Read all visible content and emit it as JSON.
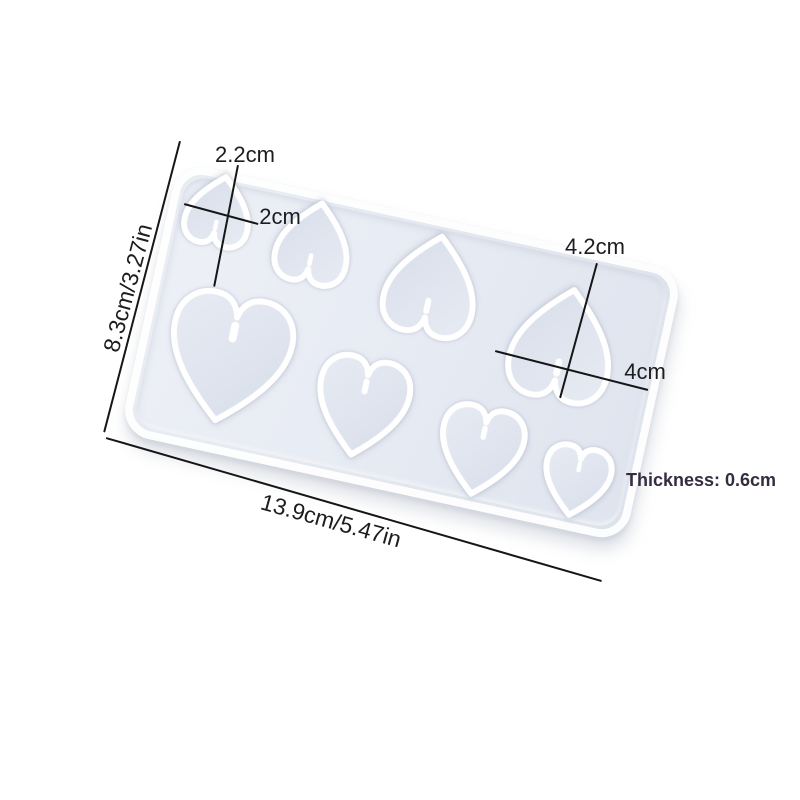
{
  "canvas": {
    "width": 800,
    "height": 800,
    "background": "#ffffff"
  },
  "mold": {
    "name": "heart pendant silicone mold",
    "surface_color": "#eaedf4",
    "rim_color": "#ffffff",
    "cavity_gradient": [
      "#e7ebf3",
      "#d8deea"
    ],
    "rect": {
      "left": 143,
      "top": 213,
      "width": 517,
      "height": 278,
      "rotation_deg": 12.3,
      "corner_radius": 30
    },
    "hearts": [
      {
        "id": 1,
        "cx": 219,
        "cy": 210,
        "w": 78,
        "h": 82,
        "orientation": "inverted",
        "rotation_deg": 192
      },
      {
        "id": 2,
        "cx": 314,
        "cy": 242,
        "w": 88,
        "h": 96,
        "orientation": "inverted",
        "rotation_deg": 192
      },
      {
        "id": 3,
        "cx": 432,
        "cy": 284,
        "w": 110,
        "h": 118,
        "orientation": "inverted",
        "rotation_deg": 192
      },
      {
        "id": 4,
        "cx": 563,
        "cy": 343,
        "w": 122,
        "h": 132,
        "orientation": "inverted",
        "rotation_deg": 192
      },
      {
        "id": 5,
        "cx": 228,
        "cy": 360,
        "w": 146,
        "h": 150,
        "orientation": "standard",
        "rotation_deg": 12
      },
      {
        "id": 6,
        "cx": 361,
        "cy": 408,
        "w": 110,
        "h": 116,
        "orientation": "standard",
        "rotation_deg": 12
      },
      {
        "id": 7,
        "cx": 480,
        "cy": 452,
        "w": 100,
        "h": 104,
        "orientation": "standard",
        "rotation_deg": 12
      },
      {
        "id": 8,
        "cx": 576,
        "cy": 482,
        "w": 80,
        "h": 82,
        "orientation": "standard",
        "rotation_deg": 12
      }
    ]
  },
  "annotations": {
    "text_color": "#1d1d1f",
    "line_color": "#161616",
    "labels": {
      "mold_height": {
        "text": "8.3cm/3.27in",
        "cx": 128,
        "cy": 288,
        "rotation_deg": -75
      },
      "mold_width": {
        "text": "13.9cm/5.47in",
        "cx": 331,
        "cy": 521,
        "rotation_deg": 15.5
      },
      "small_heart_height": {
        "text": "2.2cm",
        "cx": 245,
        "cy": 155,
        "rotation_deg": 0
      },
      "small_heart_width": {
        "text": "2cm",
        "cx": 280,
        "cy": 217,
        "rotation_deg": 0
      },
      "large_heart_height": {
        "text": "4.2cm",
        "cx": 595,
        "cy": 247,
        "rotation_deg": 0
      },
      "large_heart_width": {
        "text": "4cm",
        "cx": 645,
        "cy": 372,
        "rotation_deg": 0
      },
      "thickness": {
        "text": "Thickness: 0.6cm",
        "cx": 701,
        "cy": 480,
        "rotation_deg": 0,
        "color": "#362c40"
      }
    },
    "lines": [
      {
        "name": "mold-height-dimension-line",
        "x": 180,
        "y": 140,
        "length": 301,
        "angle_deg": 104.6
      },
      {
        "name": "mold-width-dimension-line",
        "x": 106,
        "y": 437,
        "length": 516,
        "angle_deg": 16.1
      },
      {
        "name": "small-heart-height-dimension-line",
        "x": 238,
        "y": 164,
        "length": 124,
        "angle_deg": 101.1
      },
      {
        "name": "small-heart-width-dimension-line",
        "x": 184,
        "y": 203,
        "length": 77,
        "angle_deg": 15.1
      },
      {
        "name": "large-heart-height-dimension-line",
        "x": 597,
        "y": 262,
        "length": 140,
        "angle_deg": 105.3
      },
      {
        "name": "large-heart-width-dimension-line",
        "x": 495,
        "y": 350,
        "length": 158,
        "angle_deg": 14.3
      }
    ]
  }
}
